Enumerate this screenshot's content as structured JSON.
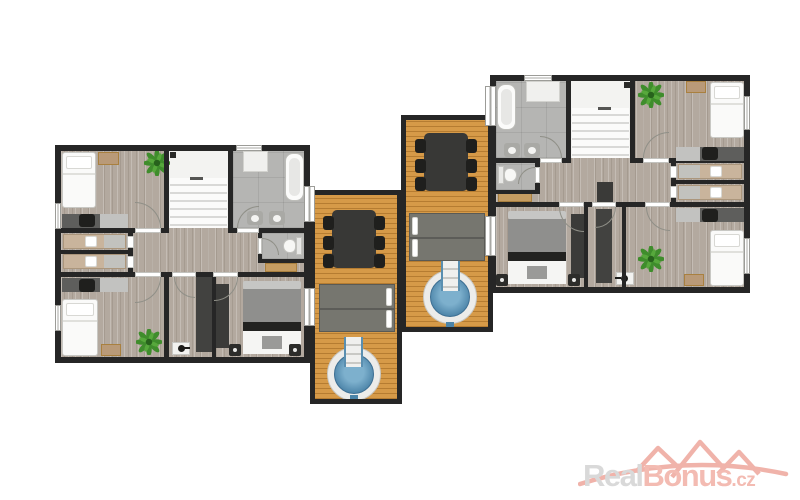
{
  "app": {
    "type": "real-estate-floor-plan-rendering",
    "background": "#ffffff",
    "visible_text": "watermark only"
  },
  "watermark": {
    "real": "Real",
    "bonus": "Bonus",
    "tld": ".cz",
    "real_color": "#d9d9d9",
    "accent_color": "#f3bbb2",
    "roofs_color": "#f0b3aa"
  },
  "palette": {
    "wall": "#262626",
    "room_wood_floor": "#b3a99f",
    "bathroom_tile": "#b5b5b3",
    "stairs": "#f3f3f1",
    "deck_wood": "#d69a48",
    "hot_tub_water": "#4e87ac",
    "hot_tub_rim": "#ececea",
    "plant_green": "#3f8d2c",
    "double_bed_blanket": "#8f8f8d",
    "daybed_gray": "#76766f",
    "table_dark": "#383836",
    "dresser_tan": "#c69d62",
    "wardrobe_dark": "#3b3b3b"
  },
  "floor_plan": {
    "units": [
      {
        "id": "left-apartment",
        "rooms": [
          "twin-bedroom-top-left",
          "staircase",
          "bathroom",
          "wc",
          "hallway",
          "bunk-room-upper",
          "bunk-room-lower",
          "twin-bedroom-bottom-left",
          "closet-vestibule",
          "double-bedroom"
        ],
        "furniture": [
          "single-bed",
          "nightstand",
          "potted-plant",
          "desk-with-chair",
          "wall-cabinet",
          "bathtub",
          "twin-sinks",
          "toilet",
          "double-bed-with-bench",
          "wardrobe",
          "tan-dresser",
          "wash-basin"
        ]
      },
      {
        "id": "right-apartment",
        "rooms": [
          "bathroom",
          "staircase",
          "twin-bedroom-top-right",
          "wc",
          "hallway",
          "bunk-room-upper",
          "bunk-room-lower",
          "double-bedroom",
          "closet-vestibule",
          "twin-bedroom-bottom-right"
        ],
        "furniture": [
          "bathtub",
          "wall-cabinet",
          "twin-sinks",
          "toilet",
          "single-bed",
          "nightstand",
          "potted-plant",
          "desk-with-chair",
          "double-bed-with-bench",
          "wardrobe",
          "tan-dresser",
          "wash-basin"
        ]
      }
    ],
    "decks": [
      {
        "id": "left-terrace",
        "features": [
          "dining-table-with-six-chairs",
          "double-lounger",
          "hot-tub-with-steps"
        ]
      },
      {
        "id": "right-terrace",
        "features": [
          "dining-table-with-six-chairs",
          "double-lounger",
          "hot-tub-with-steps"
        ]
      }
    ]
  }
}
